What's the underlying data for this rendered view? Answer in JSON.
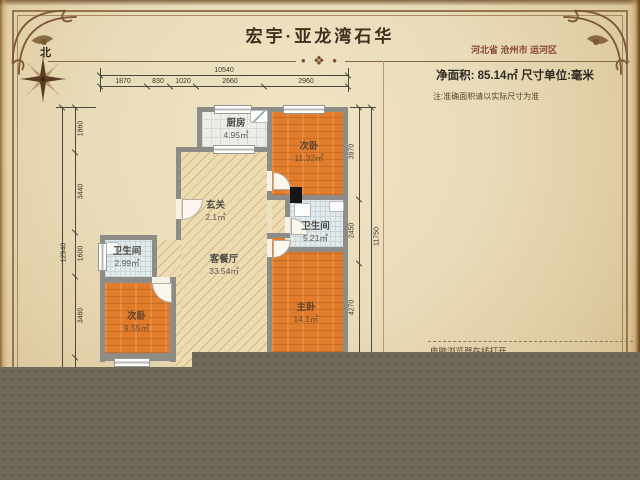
{
  "header": {
    "north_label": "北",
    "title": "宏宇·亚龙湾石华",
    "ornament": "• ❖ •",
    "location": "河北省 沧州市 运河区",
    "area_line": "净面积: 85.14㎡  尺寸单位:毫米",
    "note_line": "注:准确面积请以实际尺寸为准"
  },
  "plan": {
    "rooms": [
      {
        "name": "厨房",
        "area": "4.95㎡"
      },
      {
        "name": "次卧",
        "area": "11.32㎡"
      },
      {
        "name": "玄关",
        "area": "2.1㎡"
      },
      {
        "name": "卫生间",
        "area": "5.21㎡"
      },
      {
        "name": "卫生间",
        "area": "2.99㎡"
      },
      {
        "name": "客餐厅",
        "area": "33.54㎡"
      },
      {
        "name": "次卧",
        "area": "9.55㎡"
      },
      {
        "name": "主卧",
        "area": "14.1㎡"
      }
    ]
  },
  "dimensions": {
    "top_total": "10540",
    "top_segments": [
      "1870",
      "830",
      "1020",
      "2660",
      "2960"
    ],
    "left_total": "12940",
    "left_segments": [
      "1860",
      "3440",
      "1600",
      "3460"
    ],
    "right_total": "11750",
    "right_segments": [
      "3970",
      "2450",
      "4270"
    ]
  },
  "footer": {
    "print_note": "电脑浏览器在线打开,"
  },
  "colors": {
    "wall": "#8d8c87",
    "wood_floor": "#e07c2c",
    "tile_floor": "#e3eaec",
    "kitchen_floor": "#edeeea",
    "hatch_floor": "#eddcb2",
    "overlay": "#6f6a57",
    "frame_accent": "#96764c",
    "location_text": "#8a4636"
  }
}
